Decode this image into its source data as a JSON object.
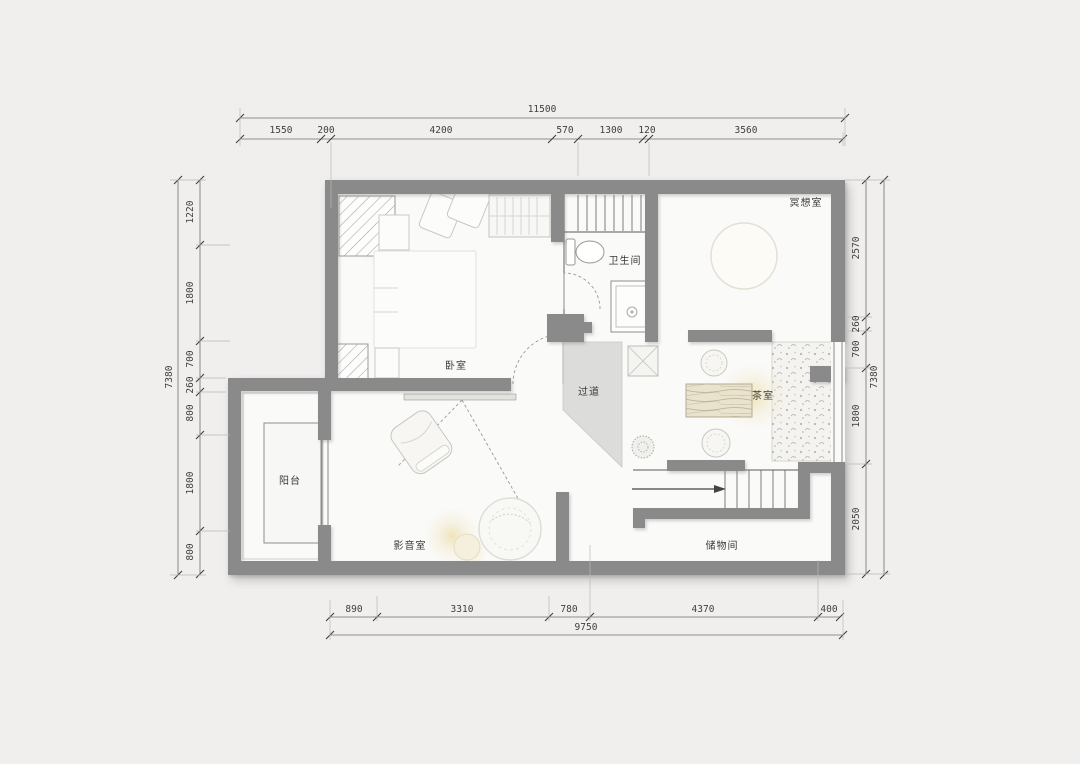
{
  "colors": {
    "bg": "#f0efee",
    "wall": "#8a8a8a",
    "floor": "#fafaf8",
    "hall": "#dcdcda",
    "glow": "#efe3b4",
    "dimtext": "#3f3f3f",
    "labeltext": "#3a3a3a"
  },
  "dims": {
    "top": {
      "total": "11500",
      "segments": [
        "1550",
        "200",
        "4200",
        "570",
        "1300",
        "120",
        "3560"
      ]
    },
    "bottom": {
      "total": "9750",
      "segments": [
        "890",
        "3310",
        "780",
        "4370",
        "400"
      ]
    },
    "left": {
      "total": "7380",
      "segments": [
        "1220",
        "1800",
        "700",
        "260",
        "800",
        "1800",
        "800"
      ]
    },
    "right": {
      "total": "7380",
      "segments": [
        "2570",
        "260",
        "700",
        "1800",
        "2050"
      ]
    }
  },
  "rooms": {
    "bedroom": "卧室",
    "bathroom": "卫生间",
    "meditation": "冥想室",
    "hallway": "过道",
    "tea_room": "茶室",
    "balcony": "阳台",
    "media_room": "影音室",
    "storage": "储物间"
  }
}
